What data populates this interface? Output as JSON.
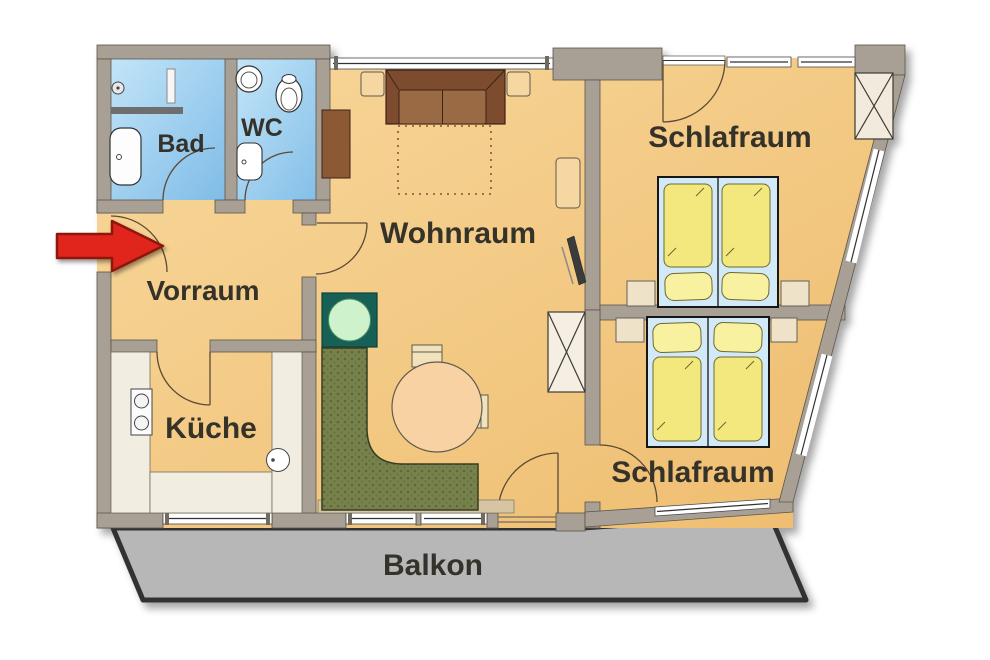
{
  "floorplan": {
    "rooms": {
      "bad": {
        "label": "Bad"
      },
      "wc": {
        "label": "WC"
      },
      "vorraum": {
        "label": "Vorraum"
      },
      "wohnraum": {
        "label": "Wohnraum"
      },
      "kueche": {
        "label": "Küche"
      },
      "schlafraum_oben": {
        "label": "Schlafraum"
      },
      "schlafraum_unten": {
        "label": "Schlafraum"
      },
      "balkon": {
        "label": "Balkon"
      }
    },
    "colors": {
      "wall": "#a9a095",
      "floor": "#f4c983",
      "wet_room": "#9fcdef",
      "balcony": "#b7b7b7",
      "entrance_arrow": "#e0251b",
      "wood_furniture": "#8b5a36",
      "bedding": "#f2e87d",
      "bench": "#76814c",
      "plant_table": "#156158"
    }
  }
}
